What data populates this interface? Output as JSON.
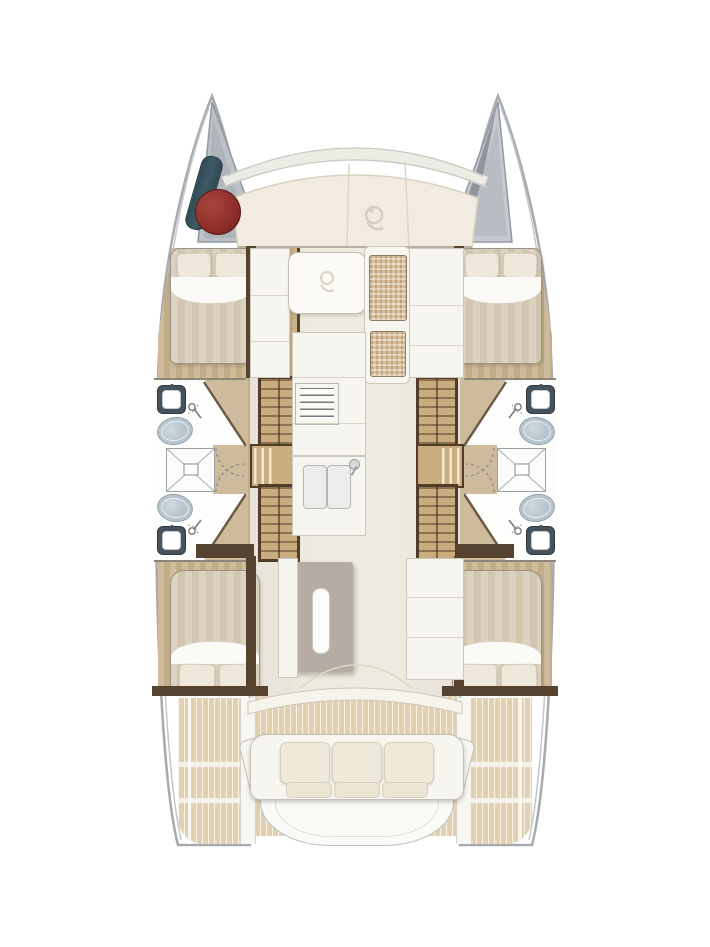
{
  "diagram": {
    "kind": "catamaran yacht deck / accommodation floor plan",
    "view": "overhead plan, bow at top, stern at bottom",
    "hull_count": 2,
    "symmetry": "port and starboard hulls mirrored"
  },
  "areas": {
    "port_hull": [
      "forward double cabin",
      "forward head",
      "central shower stall",
      "aft head",
      "aft double cabin"
    ],
    "starboard_hull": [
      "forward double cabin",
      "forward head",
      "central shower stall",
      "aft head",
      "aft double cabin"
    ],
    "main_deck": [
      "foredeck sun lounge",
      "salon table with woven bench",
      "galley with sink and stove",
      "galley island",
      "aft cockpit sofa",
      "transom platform"
    ],
    "bow": [
      "port anchor locker with fender and buoy",
      "starboard rope locker"
    ]
  },
  "fixtures": {
    "double_berths": 4,
    "toilets": 4,
    "head_sinks": 4,
    "shower_stalls": 2,
    "shower_mixers": 4,
    "companionway_stairs": 4,
    "galley_sink_basins": 2,
    "stoves": 1,
    "cockpit_sofa_back_cushions": 3,
    "cockpit_sofa_seat_cushions": 3,
    "bow_fenders": 1,
    "bow_buoys": 1
  },
  "colors": {
    "outline": "#a7aaae",
    "hull-line": "#c3c6c9",
    "locker-gray": "#bcc1c6",
    "locker-gray2": "#c6cad0",
    "locker-dark": "#8f959b",
    "deck-cream": "#f1ecdf",
    "deck-seam": "#d7d1bf",
    "salon-floor": "#eae5db",
    "wood-light": "#cdbb9b",
    "wood-dark": "#c2ad87",
    "stair-wood": "#c9ad7e",
    "stair-frame": "#503c28",
    "wall-dark": "#554330",
    "bed-stripe-a": "#dcd2c1",
    "bed-stripe-b": "#d2c6af",
    "linen-white": "#fbfaf6",
    "pillow": "#eee8da",
    "pillow-edge": "#d8d1c0",
    "bath-white": "#fdfdfb",
    "fixture-line": "#9aa0a6",
    "toilet-blue": "#b7c4cd",
    "toilet-edge": "#91a2ad",
    "sink-dark": "#46525c",
    "island-gray": "#b5aca3",
    "island-handle": "#fbfbf9",
    "cockpit-wood": "#e2d1b0",
    "cockpit-seam": "#f4f2ea",
    "panel-white": "#f6f5ef",
    "panel-edge": "#cdc8ba",
    "cushion": "#efe9da",
    "cushion-edge": "#d8d1bf",
    "woven": "#d9c09c",
    "buoy-red": "#8e2e29",
    "fender-teal": "#3d5a66",
    "arc-line": "#8a8a84",
    "threshold": "#f6f4ed",
    "platform": "#fafaf7",
    "logo-line": "#d5cfbc"
  }
}
